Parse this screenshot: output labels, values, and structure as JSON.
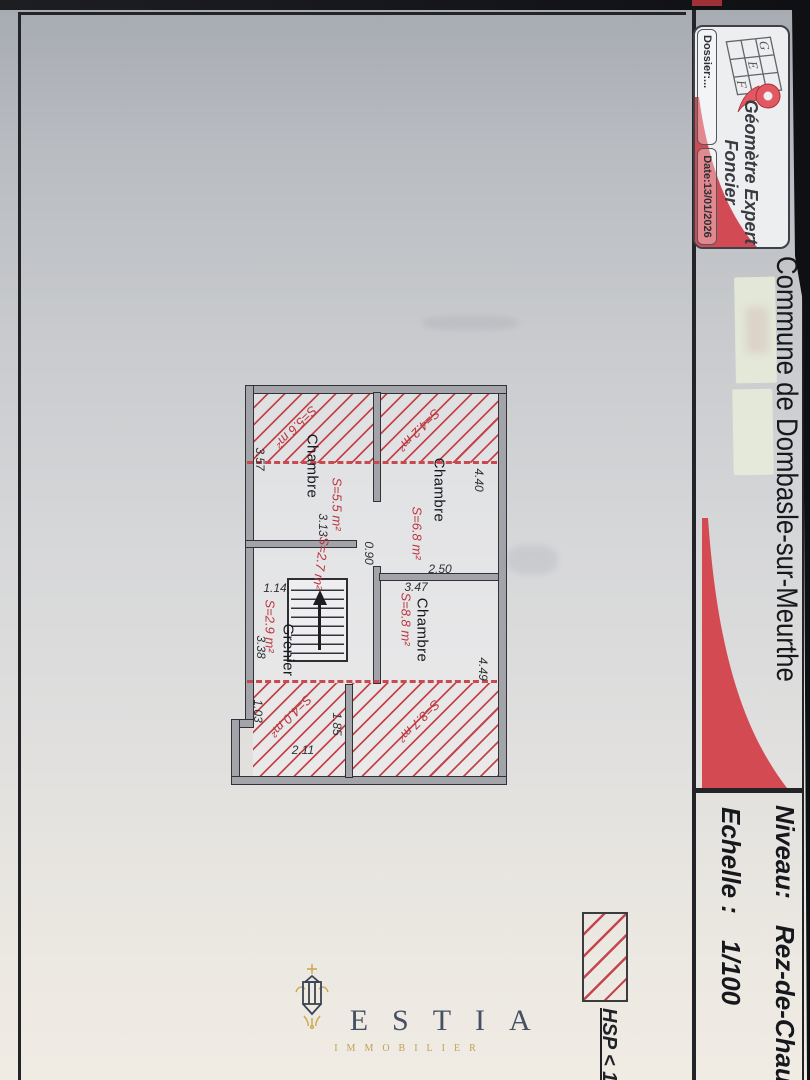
{
  "colors": {
    "accent_red": "#d44a53",
    "hatch_red": "#c4454c",
    "estia_navy": "#39465a",
    "estia_gold": "#bd9c4a"
  },
  "title_block": {
    "logo": {
      "grid_letters": [
        "G",
        "E",
        "F"
      ],
      "name_line1": "Géomètre Expert",
      "name_line2": "Foncier",
      "dossier": "Dossier:...",
      "date": "Date:13/01/2026"
    },
    "commune_title": "Commune de Dombasle-sur-Meurthe",
    "niveau_label": "Niveau:",
    "niveau_value": "Rez-de-Chauss",
    "echelle_label": "Echelle :",
    "echelle_value": "1/100"
  },
  "legend": {
    "hsp": "HSP < 1.80 m"
  },
  "floor_plan": {
    "rooms": [
      {
        "name": "Chambre",
        "area": "S=5.5 m²"
      },
      {
        "name": "Chambre",
        "area": "S=6.8 m²"
      },
      {
        "name": "Chambre",
        "area": "S=8.8 m²"
      },
      {
        "name": "Grenier",
        "area": "S=2.9 m²"
      }
    ],
    "landing_area": "S=2.7 m²",
    "hatched_zones": [
      {
        "area": "S=5.6 m²"
      },
      {
        "area": "S=4.2 m²"
      },
      {
        "area": "S=8.7 m²"
      },
      {
        "area": "S=4.0 m²"
      }
    ],
    "dimensions": {
      "d440": "4.40",
      "d357": "3.57",
      "d313": "3.13",
      "d090": "0.90",
      "d250": "2.50",
      "d347": "3.47",
      "d114": "1.14",
      "d338": "3.38",
      "d449": "4.49",
      "d211": "2.11",
      "d103": "1.03",
      "d185": "1.85"
    }
  },
  "watermark": {
    "brand": "ESTIA",
    "tagline": "IMMOBILIER"
  }
}
